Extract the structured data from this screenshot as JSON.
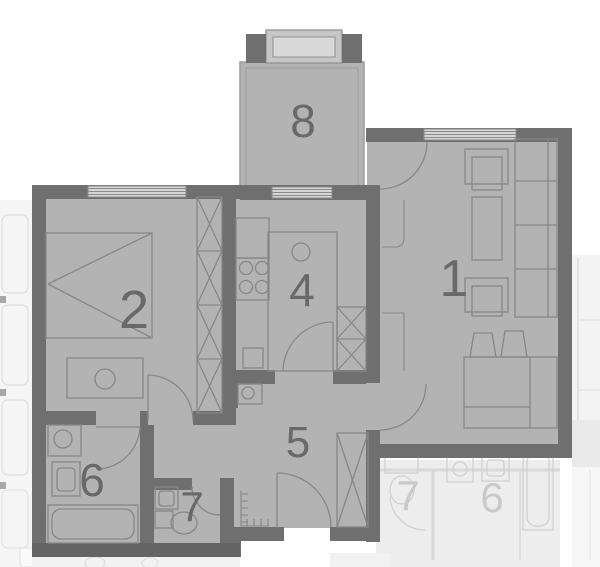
{
  "plan": {
    "type": "apartment-floor-plan",
    "rooms": [
      {
        "label": "1",
        "name": "living-room"
      },
      {
        "label": "2",
        "name": "bedroom"
      },
      {
        "label": "4",
        "name": "kitchen"
      },
      {
        "label": "5",
        "name": "hallway"
      },
      {
        "label": "6",
        "name": "bathroom"
      },
      {
        "label": "7",
        "name": "wc"
      },
      {
        "label": "8",
        "name": "balcony"
      }
    ],
    "neighbor_rooms": [
      {
        "label": "7"
      },
      {
        "label": "6"
      }
    ],
    "colors": {
      "background": "#ffffff",
      "floor": "#b3b3b3",
      "wall": "#6f6f6f",
      "detail_line": "#878787",
      "window": "#d6d6d6",
      "label": "#696969",
      "neighbor_floor": "#ededed",
      "neighbor_line": "#cfcfcf",
      "neighbor_label": "#c9c9c9"
    }
  }
}
